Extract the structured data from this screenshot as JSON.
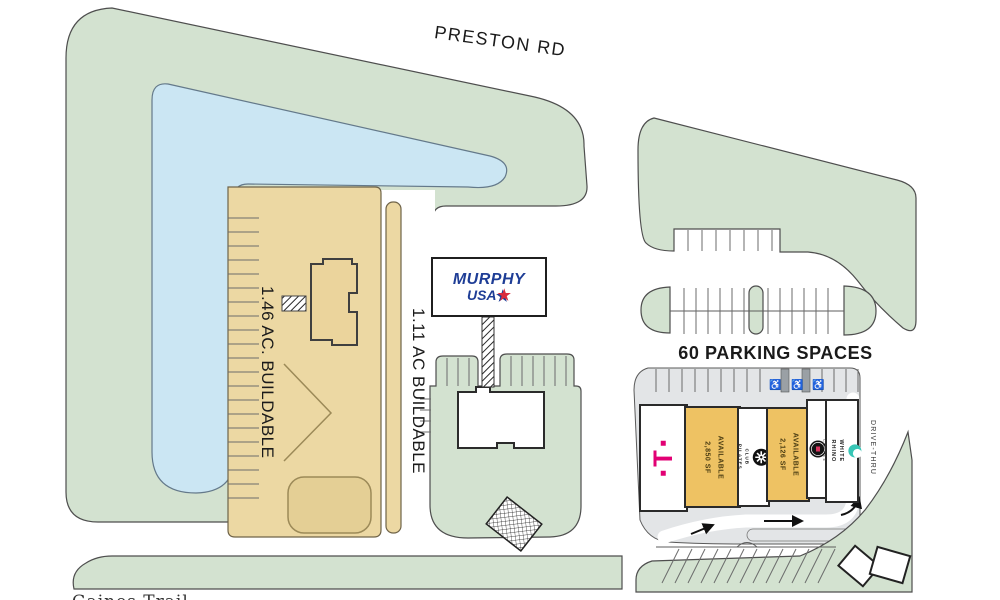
{
  "roads": {
    "preston": "PRESTON RD",
    "bottom_partial": "Gaines Trail"
  },
  "parcels": {
    "buildable_146": "1.46 AC. BUILDABLE",
    "buildable_111": "1.11 AC BUILDABLE"
  },
  "murphy_sign": {
    "line1": "MURPHY",
    "line2": "USA",
    "star": "★"
  },
  "parking_label": "60 PARKING SPACES",
  "drive_thru": "DRIVE-THRU",
  "accessibility_icon": "♿",
  "tenants": {
    "t_mobile": {
      "letter": "T"
    },
    "available_1": {
      "status": "AVAILABLE",
      "size": "2,850 SF"
    },
    "club_pilates": {
      "name": "CLUB PILATES"
    },
    "available_2": {
      "status": "AVAILABLE",
      "size": "2,126 SF"
    },
    "white_rhino": {
      "name": "WHITE RHINO",
      "sub": "COFFEE"
    }
  },
  "colors": {
    "green": "#d3e2d0",
    "green_stroke": "#4e4e4e",
    "pond": "#cbe6f3",
    "pond_stroke": "#64798a",
    "tan": "#ecd8a3",
    "tan_detail": "#9c8a58",
    "available": "#eec263",
    "gray": "#e3e5e7",
    "gray_stroke": "#5a5a5a",
    "magenta": "#e20074",
    "murphy_blue": "#1e3d96",
    "star_red": "#d92b3e",
    "teal": "#38c6b6",
    "ink": "#1a1a1a"
  }
}
